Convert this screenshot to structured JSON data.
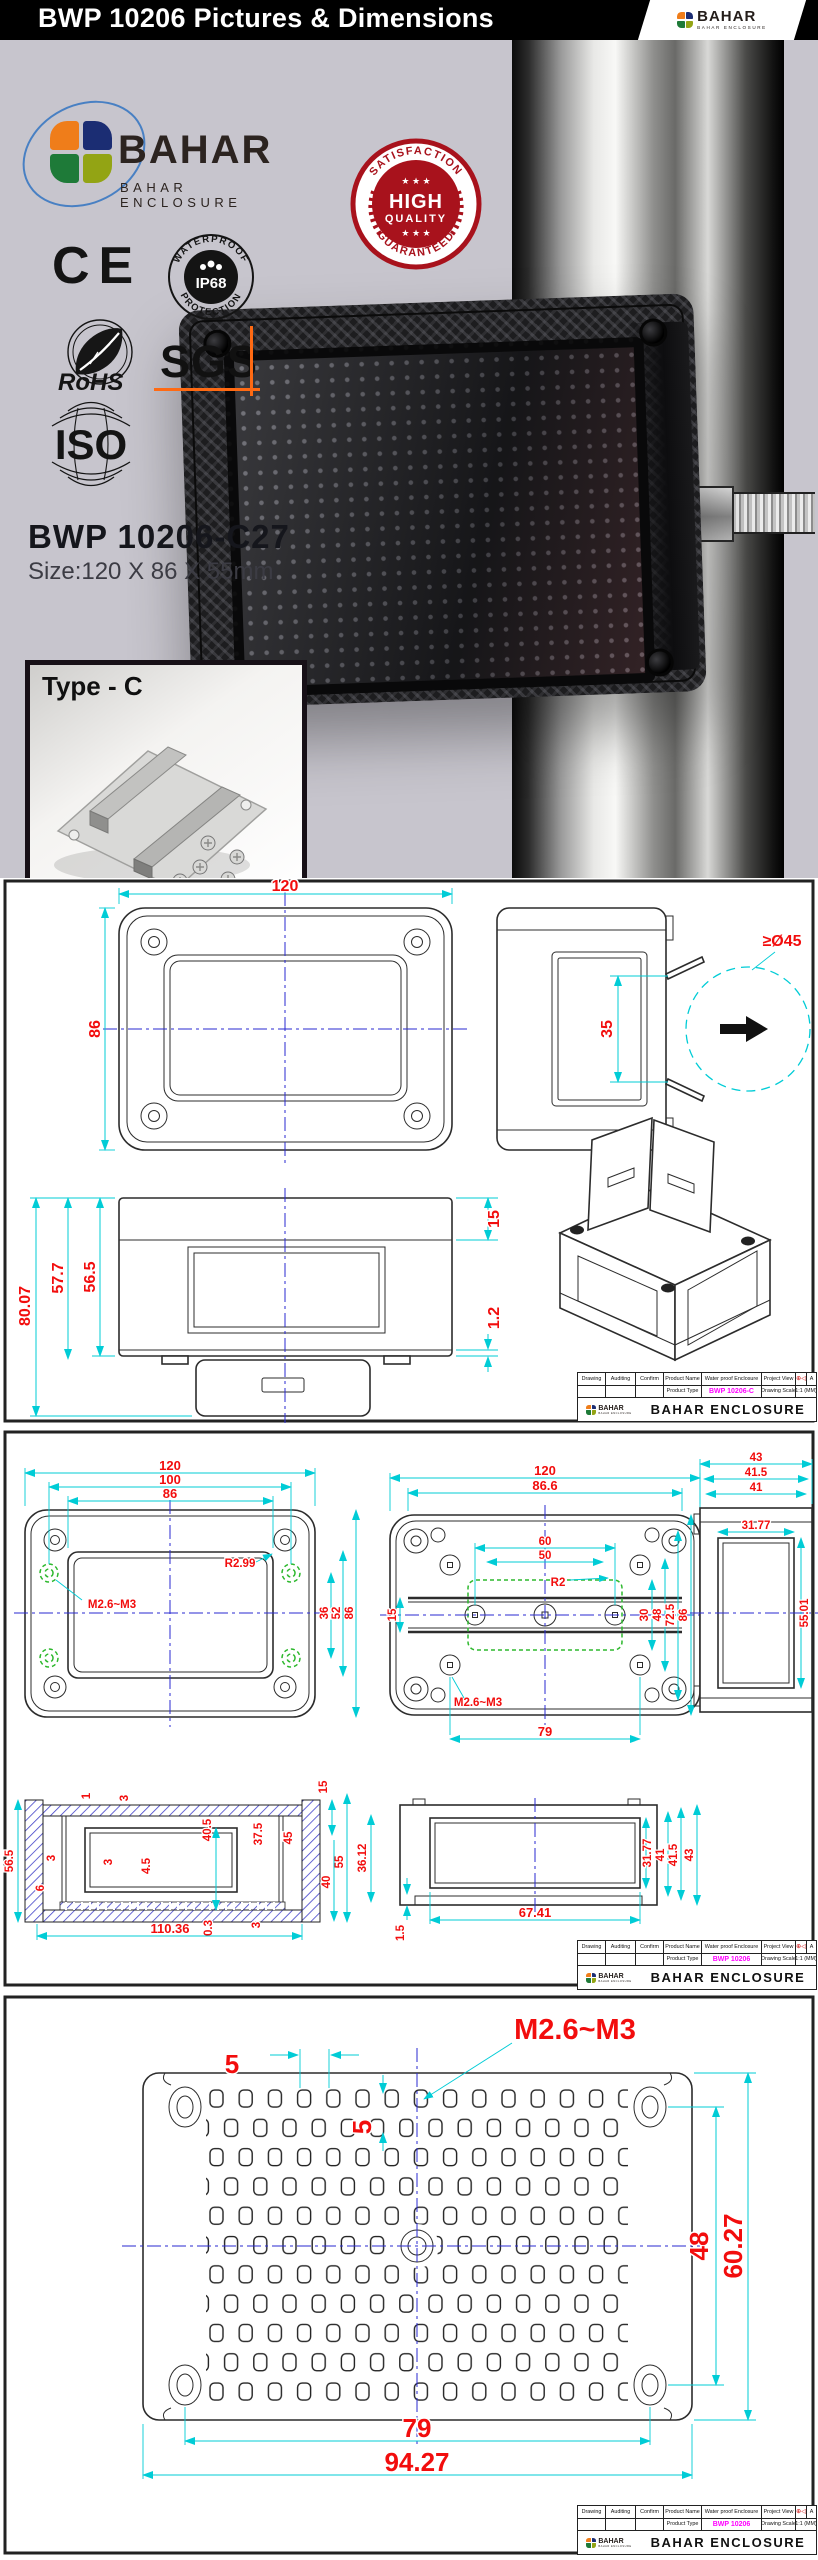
{
  "header": {
    "title": "BWP 10206 Pictures & Dimensions",
    "brand": "BAHAR",
    "brand_sub": "BAHAR ENCLOSURE"
  },
  "hero": {
    "brand": "BAHAR",
    "brand_sub": "BAHAR ENCLOSURE",
    "certs": {
      "ce": "CE",
      "ip68_top": "WATERPROOF",
      "ip68_center": "IP68",
      "ip68_bottom": "PROTECTION",
      "rohs": "RoHS",
      "sgs": "SGS",
      "iso": "ISO"
    },
    "badge": {
      "top": "SATISFACTION",
      "stars": "★ ★ ★",
      "line1": "HIGH",
      "line2": "QUALITY",
      "bottom": "GUARANTEED"
    },
    "product_code": "BWP 10206-C27",
    "size": "Size:120 X 86 X 55mm",
    "type_label": "Type - C"
  },
  "titleblock": {
    "c1": "Drawing",
    "c2": "Auditing",
    "c3": "Confirm",
    "c4": "Product Name",
    "c5": "Water proof Enclosure",
    "c6": "Project View",
    "rev": "A",
    "r2c4": "Product Type",
    "r2c6": "Drawing Scale",
    "scale": "1:1 (MM)",
    "company": "BAHAR ENCLOSURE",
    "brand": "BAHAR",
    "brand_sub": "BAHAR ENCLOSURE",
    "proj_sym": "⊕◁",
    "codes": [
      "BWP 10206-C",
      "BWP 10206",
      "BWP 10206"
    ]
  },
  "d1": {
    "top_w": "120",
    "top_h": "86",
    "side_win": "35",
    "pole_dia": "≥Ø45",
    "front_t": "15",
    "front_lip": "1.2",
    "front_h_total": "80.07",
    "front_h1": "57.7",
    "front_h2": "56.5"
  },
  "d2": {
    "lid": {
      "w1": "120",
      "w2": "100",
      "w3": "86",
      "r": "R2.99",
      "thread": "M2.6~M3",
      "v1": "36",
      "v2": "52",
      "v3": "86"
    },
    "base": {
      "w1": "120",
      "w2": "86.6",
      "w3": "60",
      "w4": "50",
      "r": "R2",
      "v0": "15",
      "v1": "30",
      "v2": "48",
      "v3": "72.5",
      "v4": "86",
      "thread": "M2.6~M3",
      "w5": "79"
    },
    "side": {
      "w1": "43",
      "w2": "41.5",
      "w3": "41",
      "w4": "31.77",
      "v1": "55.01"
    },
    "xsec": {
      "v0": "56.5",
      "a1": "1",
      "a2": "3",
      "a3": "40.5",
      "a4": "37.5",
      "a5": "45",
      "a6": "15",
      "a7": "55",
      "a8": "40",
      "a9": "3",
      "a10": "4.5",
      "a11": "3",
      "a12": "6",
      "b1": "0.3",
      "b2": "3",
      "w": "110.36",
      "v1": "36.12"
    },
    "elev": {
      "v1": "31.77",
      "w1": "67.41",
      "a1": "1.5",
      "r1": "41",
      "r2": "41.5",
      "r3": "43"
    }
  },
  "d3": {
    "s1": "5",
    "s2": "5",
    "thread": "M2.6~M3",
    "v1": "48",
    "v2": "60.27",
    "w1": "79",
    "w2": "94.27"
  },
  "colors": {
    "dim_red": "#f20d0d",
    "dim_cyan": "#00ccd6",
    "centerline_blue": "#2a2ad2",
    "boss_green": "#2db82d",
    "code_magenta": "#ff00ff",
    "badge_red": "#a8121c",
    "sgs_orange": "#ff6a13",
    "header_bg": "#000000",
    "hero_bg": "#c7c5cd"
  }
}
